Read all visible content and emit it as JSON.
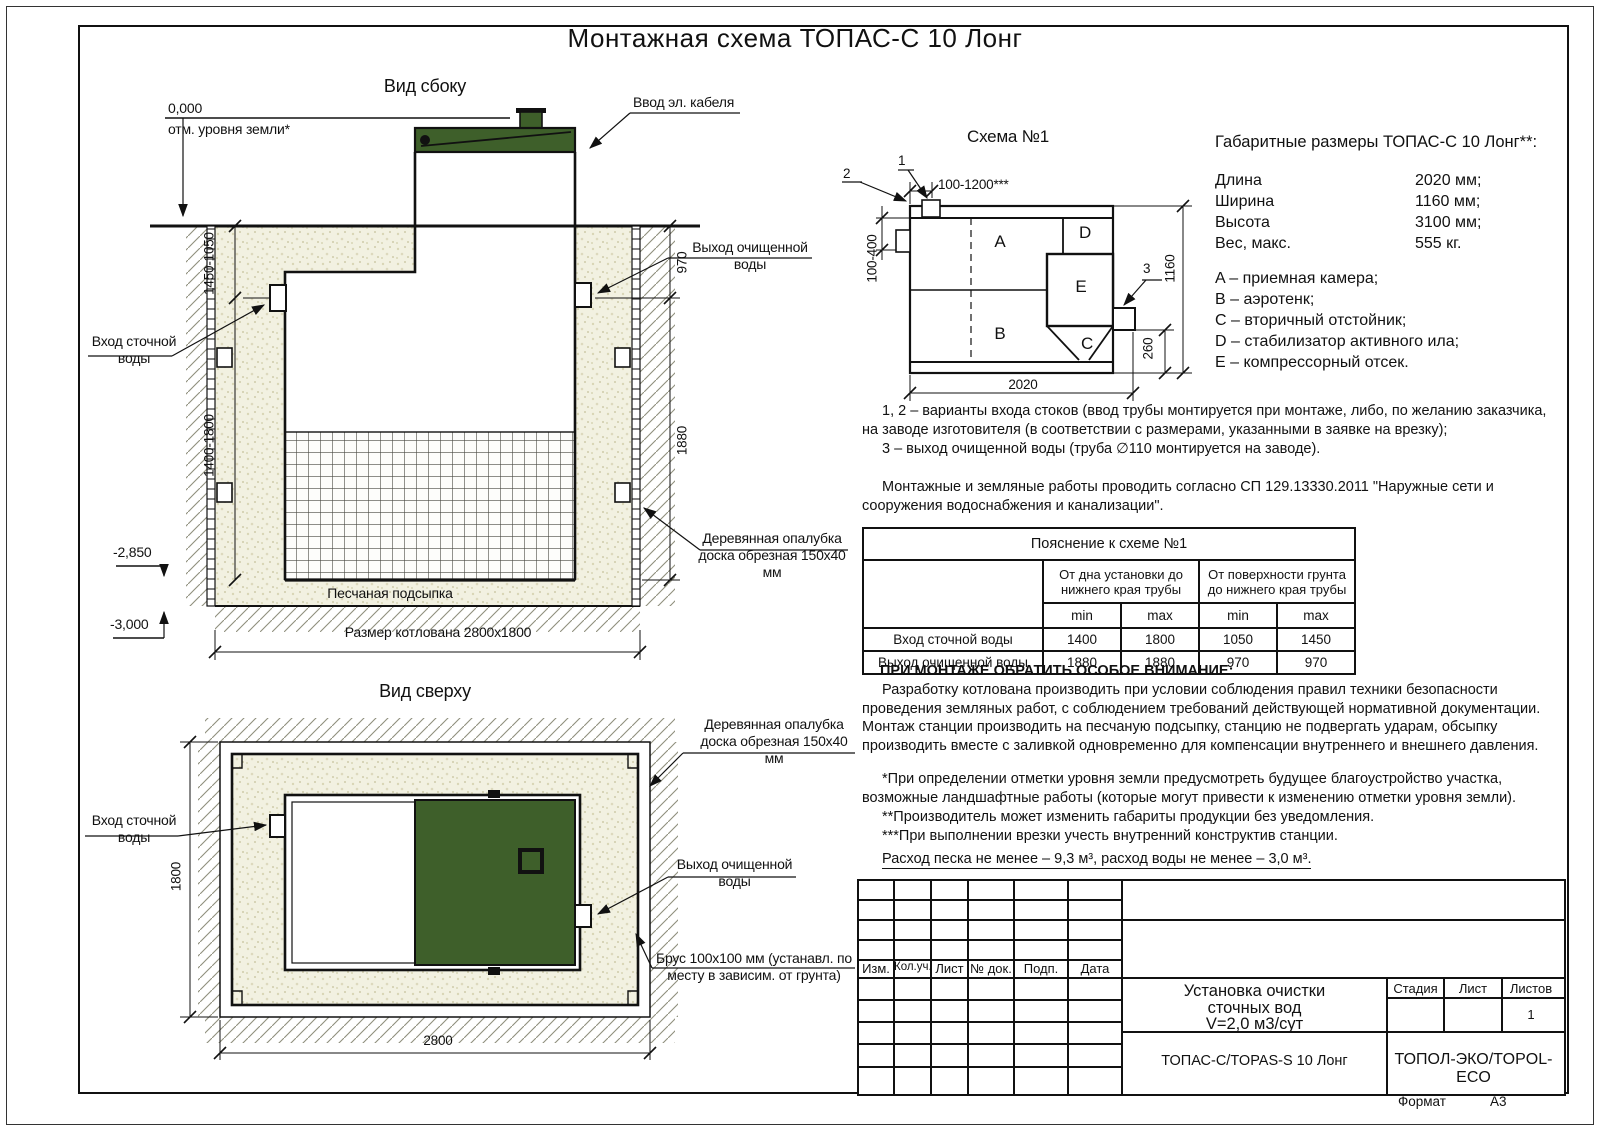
{
  "page": {
    "title": "Монтажная схема ТОПАС-С 10 Лонг"
  },
  "side_view": {
    "title": "Вид сбоку",
    "zero_mark": "0,000",
    "ground_label": "отм. уровня земли*",
    "cable_label": "Ввод эл. кабеля",
    "inlet_label": "Вход сточной воды",
    "outlet_label": "Выход очищенной воды",
    "formwork_label": "Деревянная опалубка доска обрезная 150x40 мм",
    "sand_label": "Песчаная подсыпка",
    "pit_label": "Размер котлована 2800x1800",
    "lvl_2850": "-2,850",
    "lvl_3000": "-3,000",
    "dim_a": "1450-1050",
    "dim_b": "1400-1800",
    "dim_c": "970",
    "dim_d": "1880"
  },
  "top_view": {
    "title": "Вид сверху",
    "inlet_label": "Вход сточной воды",
    "outlet_label": "Выход очищенной воды",
    "formwork_label": "Деревянная опалубка доска обрезная 150x40 мм",
    "beam_label": "Брус 100х100 мм (устанавл. по месту в зависим. от грунта)",
    "dim_w": "1800",
    "dim_l": "2800"
  },
  "schema": {
    "title": "Схема №1",
    "c1": "1",
    "c2": "2",
    "c3": "3",
    "dim_top": "100-1200***",
    "dim_left": "100-400",
    "dim_length": "2020",
    "dim_height": "1160",
    "dim_offset": "260",
    "comp_a": "A",
    "comp_b": "B",
    "comp_c": "C",
    "comp_d": "D",
    "comp_e": "E"
  },
  "specs": {
    "title": "Габаритные размеры ТОПАС-С 10 Лонг**:",
    "rows": [
      {
        "label": "Длина",
        "value": "2020 мм;"
      },
      {
        "label": "Ширина",
        "value": "1160 мм;"
      },
      {
        "label": "Высота",
        "value": "3100 мм;"
      },
      {
        "label": "Вес, макс.",
        "value": "555 кг."
      }
    ],
    "legend": [
      "A – приемная камера;",
      "B – аэротенк;",
      "C – вторичный отстойник;",
      "D – стабилизатор активного ила;",
      "E – компрессорный отсек."
    ]
  },
  "notes": {
    "n12": "1, 2 – варианты входа стоков (ввод трубы монтируется при монтаже, либо, по желанию заказчика, на заводе изготовителя (в соответствии с размерами, указанными в заявке на врезку);",
    "n3": "3 – выход очищенной воды (труба ∅110 монтируется на заводе).",
    "sp": "Монтажные и земляные работы проводить согласно СП 129.13330.2011 \"Наружные сети и сооружения водоснабжения и канализации\"."
  },
  "table": {
    "title": "Пояснение к схеме №1",
    "group1": "От дна установки до нижнего края трубы",
    "group2": "От поверхности грунта до нижнего края трубы",
    "min1": "min",
    "max1": "max",
    "min2": "min",
    "max2": "max",
    "rows": [
      {
        "label": "Вход сточной воды",
        "a": "1400",
        "b": "1800",
        "c": "1050",
        "d": "1450"
      },
      {
        "label": "Выход очищенной воды",
        "a": "1880",
        "b": "1880",
        "c": "970",
        "d": "970"
      }
    ]
  },
  "attention": {
    "title": "ПРИ МОНТАЖЕ ОБРАТИТЬ ОСОБОЕ ВНИМАНИЕ:",
    "body": "Разработку котлована производить при условии соблюдения правил техники безопасности проведения земляных работ, с соблюдением требований действующей нормативной документации. Монтаж станции производить на песчаную подсыпку, станцию не подвергать ударам, обсыпку производить вместе с заливкой одновременно для компенсации внутреннего и внешнего давления.",
    "star1": "*При определении отметки уровня земли предусмотреть будущее благоустройство участка, возможные ландшафтные работы (которые могут привести к изменению отметки уровня земли).",
    "star2": "**Производитель может изменить габариты продукции без уведомления.",
    "star3": "***При выполнении врезки учесть внутренний конструктив станции.",
    "consumption": "Расход песка не менее – 9,3 м³, расход воды не менее – 3,0 м³."
  },
  "title_block": {
    "cols": [
      "Изм.",
      "Кол.уч.",
      "Лист",
      "№ док.",
      "Подп.",
      "Дата"
    ],
    "doc_line1": "Установка очистки",
    "doc_line2": "сточных вод",
    "doc_line3": "V=2,0 м3/сут",
    "stage": "Стадия",
    "sheet": "Лист",
    "sheets": "Листов",
    "sheets_value": "1",
    "model": "ТОПАС-С/TOPAS-S 10 Лонг",
    "company": "ТОПОЛ-ЭКО/TOPOL-ECO",
    "format_label": "Формат",
    "format_value": "А3"
  },
  "colors": {
    "green": "#3e5f2a",
    "sand": "#f2f1e1",
    "line": "#111111"
  }
}
